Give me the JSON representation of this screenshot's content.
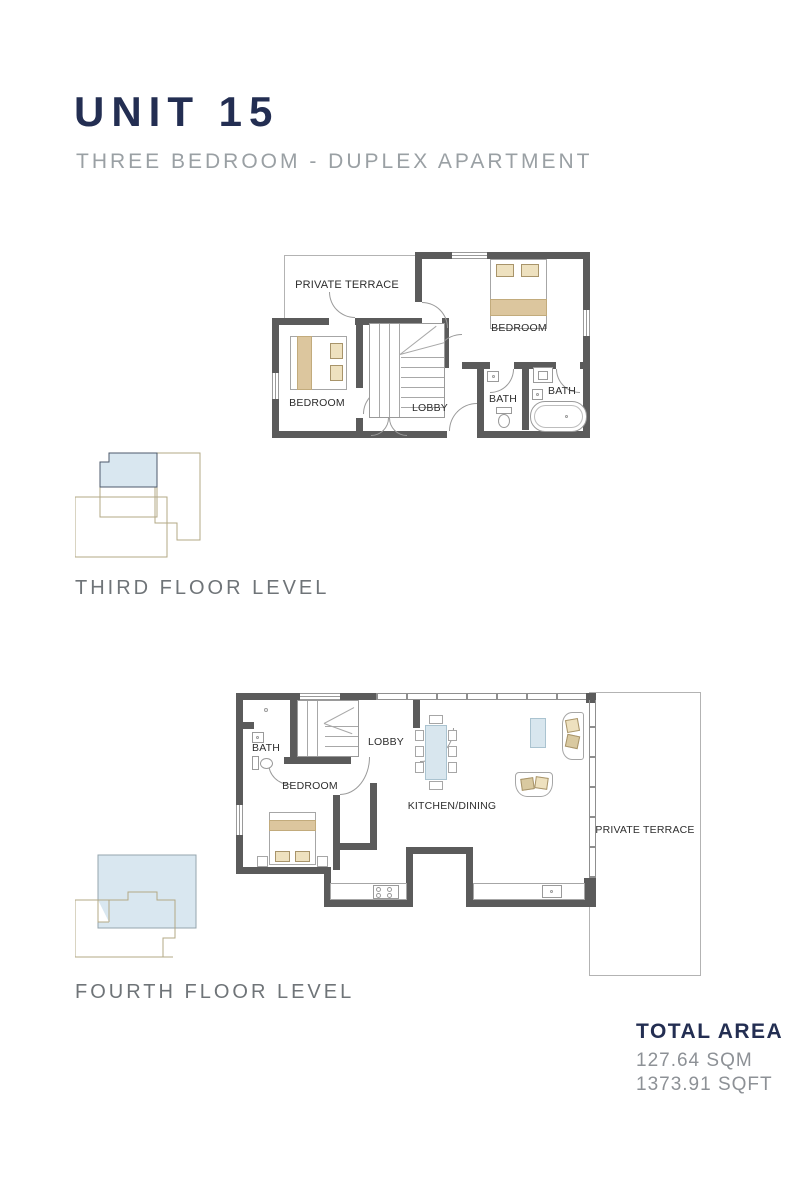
{
  "header": {
    "title": "UNIT 15",
    "subtitle": "THREE BEDROOM - DUPLEX APARTMENT"
  },
  "third_floor": {
    "caption": "THIRD FLOOR LEVEL",
    "labels": {
      "terrace": "PRIVATE TERRACE",
      "bedroom_right": "BEDROOM",
      "bedroom_left": "BEDROOM",
      "lobby": "LOBBY",
      "bath_inner": "BATH",
      "bath_outer": "BATH"
    }
  },
  "fourth_floor": {
    "caption": "FOURTH FLOOR LEVEL",
    "labels": {
      "bath": "BATH",
      "lobby": "LOBBY",
      "bedroom": "BEDROOM",
      "kitchen": "KITCHEN/DINING",
      "terrace": "PRIVATE TERRACE"
    }
  },
  "total_area": {
    "heading": "TOTAL AREA",
    "sqm": "127.64 SQM",
    "sqft": "1373.91 SQFT"
  },
  "colors": {
    "navy": "#232e52",
    "wall_gray": "#5b5b5b",
    "text_gray": "#8d9196",
    "bed_tan": "#dcc69e",
    "table_blue": "#d8e6ee",
    "keyplan_blue": "#d9e7f0",
    "keyplan_outline_tan": "#b3a886"
  }
}
